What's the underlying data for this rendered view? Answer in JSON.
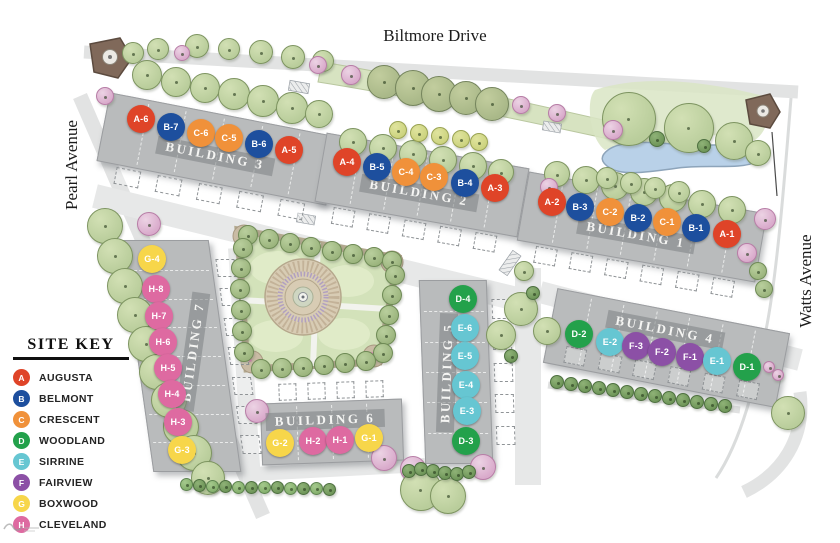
{
  "streets": {
    "top": "Biltmore Drive",
    "left": "Pearl Avenue",
    "right": "Watts Avenue"
  },
  "site_key": {
    "title": "SITE KEY",
    "entries": [
      {
        "letter": "A",
        "name": "AUGUSTA",
        "color": "#df4428"
      },
      {
        "letter": "B",
        "name": "BELMONT",
        "color": "#1d4f9e"
      },
      {
        "letter": "C",
        "name": "CRESCENT",
        "color": "#f0913a"
      },
      {
        "letter": "D",
        "name": "WOODLAND",
        "color": "#23a14b"
      },
      {
        "letter": "E",
        "name": "SIRRINE",
        "color": "#66c6d2"
      },
      {
        "letter": "F",
        "name": "FAIRVIEW",
        "color": "#8c50a6"
      },
      {
        "letter": "G",
        "name": "BOXWOOD",
        "color": "#f7d64a"
      },
      {
        "letter": "H",
        "name": "CLEVELAND",
        "color": "#de6aa1"
      }
    ]
  },
  "buildings": [
    {
      "name": "BUILDING 3",
      "band": {
        "cx": 217,
        "cy": 148,
        "w": 232,
        "h": 68,
        "angle": 11
      },
      "label": {
        "x": 215,
        "y": 156,
        "angle": 11
      },
      "garage": {
        "side": "bottom",
        "count": 5,
        "inside": false
      },
      "units": [
        {
          "label": "A-6",
          "x": 141,
          "y": 119
        },
        {
          "label": "B-7",
          "x": 171,
          "y": 127
        },
        {
          "label": "C-6",
          "x": 201,
          "y": 133
        },
        {
          "label": "C-5",
          "x": 229,
          "y": 138
        },
        {
          "label": "B-6",
          "x": 259,
          "y": 144
        },
        {
          "label": "A-5",
          "x": 289,
          "y": 150
        }
      ]
    },
    {
      "name": "BUILDING 2",
      "band": {
        "cx": 421,
        "cy": 184,
        "w": 204,
        "h": 68,
        "angle": 10
      },
      "label": {
        "x": 419,
        "y": 193,
        "angle": 10
      },
      "garage": {
        "side": "bottom",
        "count": 5,
        "inside": false
      },
      "units": [
        {
          "label": "A-4",
          "x": 347,
          "y": 162
        },
        {
          "label": "B-5",
          "x": 377,
          "y": 167
        },
        {
          "label": "C-4",
          "x": 406,
          "y": 172
        },
        {
          "label": "C-3",
          "x": 434,
          "y": 177
        },
        {
          "label": "B-4",
          "x": 465,
          "y": 183
        },
        {
          "label": "A-3",
          "x": 495,
          "y": 188
        }
      ]
    },
    {
      "name": "BUILDING 1",
      "band": {
        "cx": 641,
        "cy": 226,
        "w": 240,
        "h": 68,
        "angle": 10
      },
      "label": {
        "x": 636,
        "y": 235,
        "angle": 10
      },
      "garage": {
        "side": "bottom",
        "count": 6,
        "inside": false
      },
      "units": [
        {
          "label": "A-2",
          "x": 552,
          "y": 202
        },
        {
          "label": "B-3",
          "x": 580,
          "y": 207
        },
        {
          "label": "C-2",
          "x": 610,
          "y": 212
        },
        {
          "label": "B-2",
          "x": 638,
          "y": 218
        },
        {
          "label": "C-1",
          "x": 667,
          "y": 222
        },
        {
          "label": "B-1",
          "x": 696,
          "y": 228
        },
        {
          "label": "A-1",
          "x": 727,
          "y": 234
        }
      ]
    },
    {
      "name": "BUILDING 4",
      "band": {
        "cx": 665,
        "cy": 347,
        "w": 235,
        "h": 74,
        "angle": 11
      },
      "label": {
        "x": 665,
        "y": 330,
        "angle": 11
      },
      "garage": {
        "side": "bottom",
        "count": 6,
        "inside": true
      },
      "units": [
        {
          "label": "D-2",
          "x": 579,
          "y": 334
        },
        {
          "label": "E-2",
          "x": 610,
          "y": 342
        },
        {
          "label": "F-3",
          "x": 636,
          "y": 346
        },
        {
          "label": "F-2",
          "x": 662,
          "y": 352
        },
        {
          "label": "F-1",
          "x": 690,
          "y": 357
        },
        {
          "label": "E-1",
          "x": 717,
          "y": 361
        },
        {
          "label": "D-1",
          "x": 747,
          "y": 367
        }
      ]
    },
    {
      "name": "BUILDING 5",
      "band": {
        "cx": 455,
        "cy": 371,
        "w": 66,
        "h": 182,
        "skew": 2
      },
      "label": {
        "x": 447,
        "y": 373,
        "angle": -88
      },
      "garage": {
        "side": "right",
        "count": 5,
        "inside": false
      },
      "units": [
        {
          "label": "D-4",
          "x": 463,
          "y": 299
        },
        {
          "label": "E-6",
          "x": 465,
          "y": 328
        },
        {
          "label": "E-5",
          "x": 465,
          "y": 356
        },
        {
          "label": "E-4",
          "x": 466,
          "y": 385
        },
        {
          "label": "E-3",
          "x": 467,
          "y": 411
        },
        {
          "label": "D-3",
          "x": 466,
          "y": 441
        }
      ]
    },
    {
      "name": "BUILDING 6",
      "band": {
        "cx": 331,
        "cy": 431,
        "w": 140,
        "h": 60,
        "angle": -2
      },
      "label": {
        "x": 325,
        "y": 420,
        "angle": -2
      },
      "garage": {
        "side": "top",
        "count": 4,
        "inside": false
      },
      "units": [
        {
          "label": "G-2",
          "x": 280,
          "y": 443
        },
        {
          "label": "H-2",
          "x": 313,
          "y": 441
        },
        {
          "label": "H-1",
          "x": 340,
          "y": 440
        },
        {
          "label": "G-1",
          "x": 369,
          "y": 438
        }
      ]
    },
    {
      "name": "BUILDING 7",
      "band": {
        "cx": 180,
        "cy": 355,
        "w": 86,
        "h": 230,
        "skew": 8
      },
      "label": {
        "x": 193,
        "y": 352,
        "angle": -82
      },
      "garage": {
        "side": "right",
        "count": 7,
        "inside": false
      },
      "units": [
        {
          "label": "G-4",
          "x": 152,
          "y": 259
        },
        {
          "label": "H-8",
          "x": 156,
          "y": 289
        },
        {
          "label": "H-7",
          "x": 159,
          "y": 316
        },
        {
          "label": "H-6",
          "x": 163,
          "y": 342
        },
        {
          "label": "H-5",
          "x": 168,
          "y": 368
        },
        {
          "label": "H-4",
          "x": 172,
          "y": 394
        },
        {
          "label": "H-3",
          "x": 178,
          "y": 422
        },
        {
          "label": "G-3",
          "x": 182,
          "y": 450
        }
      ]
    }
  ]
}
